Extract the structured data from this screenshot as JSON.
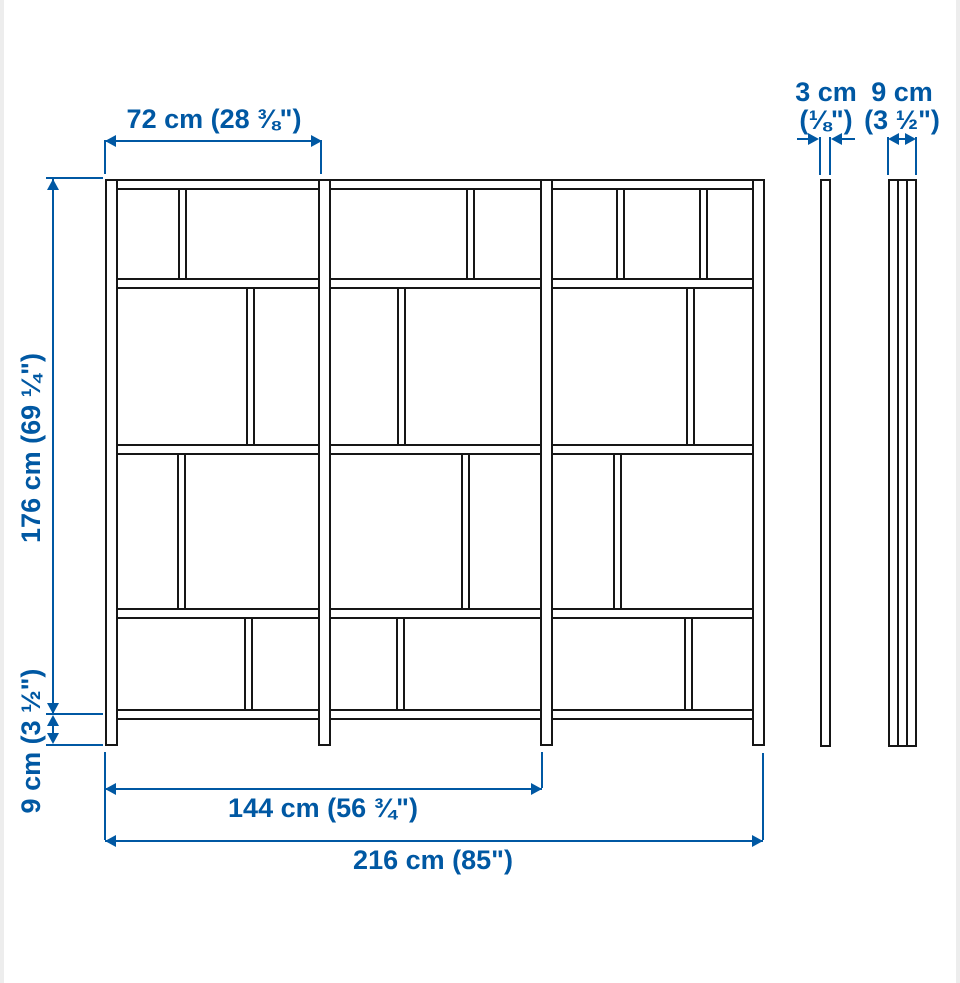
{
  "diagram": {
    "colors": {
      "dimension_blue": "#0058a3",
      "outline_black": "#161616",
      "background": "#ffffff"
    },
    "labels": {
      "section_width": "72 cm (28 ⅜\")",
      "total_height": "176 cm (69 ¼\")",
      "base_height": "9 cm (3 ½\")",
      "thickness_cm": "3 cm",
      "thickness_in": "(⅛\")",
      "depth_cm": "9 cm",
      "depth_in": "(3 ½\")",
      "two_section_width": "144 cm (56 ¾\")",
      "total_width": "216 cm (85\")"
    },
    "structure": {
      "frame": {
        "left": 105,
        "right": 765,
        "top": 179,
        "floor": 746
      },
      "posts_x": [
        105,
        318,
        540,
        752
      ],
      "post_width": 13,
      "rails_y": [
        179,
        278,
        444,
        608,
        709
      ],
      "rail_height": 11,
      "divider_width": 9,
      "rows": [
        {
          "top": 190,
          "bottom": 278,
          "divider_centers": [
            182,
            470,
            620,
            703
          ]
        },
        {
          "top": 289,
          "bottom": 444,
          "divider_centers": [
            250,
            401,
            690
          ]
        },
        {
          "top": 455,
          "bottom": 608,
          "divider_centers": [
            181,
            465,
            617
          ]
        },
        {
          "top": 619,
          "bottom": 709,
          "divider_centers": [
            248,
            400,
            688
          ]
        }
      ]
    },
    "side_views": {
      "thin_panel": {
        "x": 820,
        "width": 11,
        "top": 179,
        "bottom": 747
      },
      "deep_panel": {
        "x": 888,
        "width": 29,
        "top": 179,
        "bottom": 747,
        "inner_lines_x": [
          897,
          906
        ]
      }
    }
  }
}
